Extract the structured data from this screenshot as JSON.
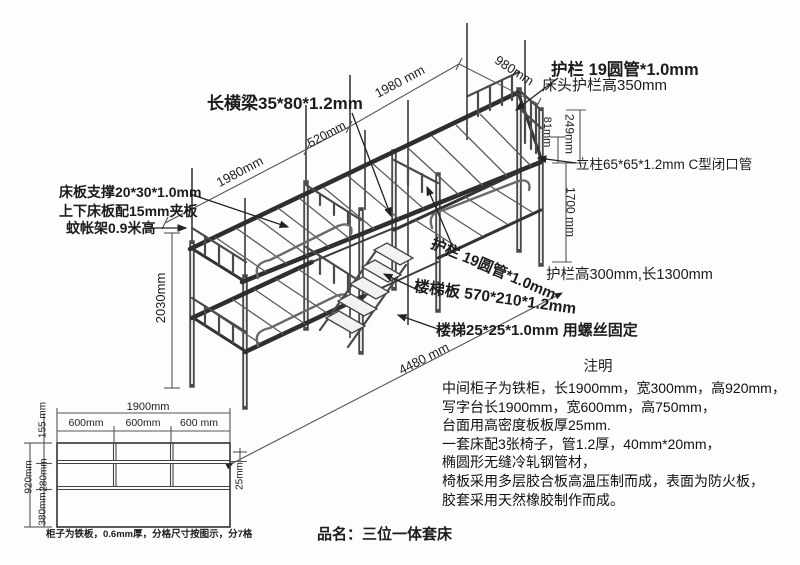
{
  "product": {
    "title": "品名：三位一体套床"
  },
  "labels": {
    "long_beam": "长横梁35*80*1.2mm",
    "board_support": "床板支撑20*30*1.0mm",
    "board_ply": "上下床板配15mm夹板",
    "mosquito_frame": "蚊帐架0.9米高",
    "guardrail_top": "护栏 19圆管*1.0mm",
    "head_guardrail": "床头护栏高350mm",
    "post": "立柱65*65*1.2mm C型闭口管",
    "guardrail_mid": "护栏 19圆管*1.0mm",
    "guardrail_lower": "护栏高300mm,长1300mm",
    "stair_plate": "楼梯板 570*210*1.2mm",
    "stair_frame": "楼梯25*25*1.0mm 用螺丝固定"
  },
  "dimensions": {
    "left_bed_length": "1980mm",
    "gap_length": "520mm",
    "right_bed_length": "1980 mm",
    "bed_width": "980mm",
    "bunk_height": "2030mm",
    "post_top_extension": "249mm",
    "rail_offset": "81mm",
    "clear_height": "1700 mm",
    "total_length": "4480 mm"
  },
  "notes": {
    "title": "注明",
    "lines": [
      "中间柜子为铁柜，长1900mm，宽300mm，高920mm，",
      "写字台长1900mm，宽600mm，高750mm，",
      "台面用高密度板板厚25mm.",
      "一套床配3张椅子，管1.2厚，40mm*20mm，",
      "椭圆形无缝冷轧钢管材，",
      "椅板采用多层胶合板高温压制而成，表面为防火板，",
      "胶套采用天然橡胶制作而成。"
    ]
  },
  "cabinet": {
    "width": "1900mm",
    "cols": [
      "600mm",
      "600mm",
      "600 mm"
    ],
    "row_top": "155 mm",
    "row_mid": "280mm",
    "row_bottom": "380mm",
    "height": "920mm",
    "shelf_thickness": "25mm",
    "caption": "柜子为铁板，0.6mm厚，分格尺寸按图示，分7格"
  },
  "colors": {
    "line": "#333333",
    "text": "#1c1c1c",
    "background": "#fdfdfd"
  }
}
